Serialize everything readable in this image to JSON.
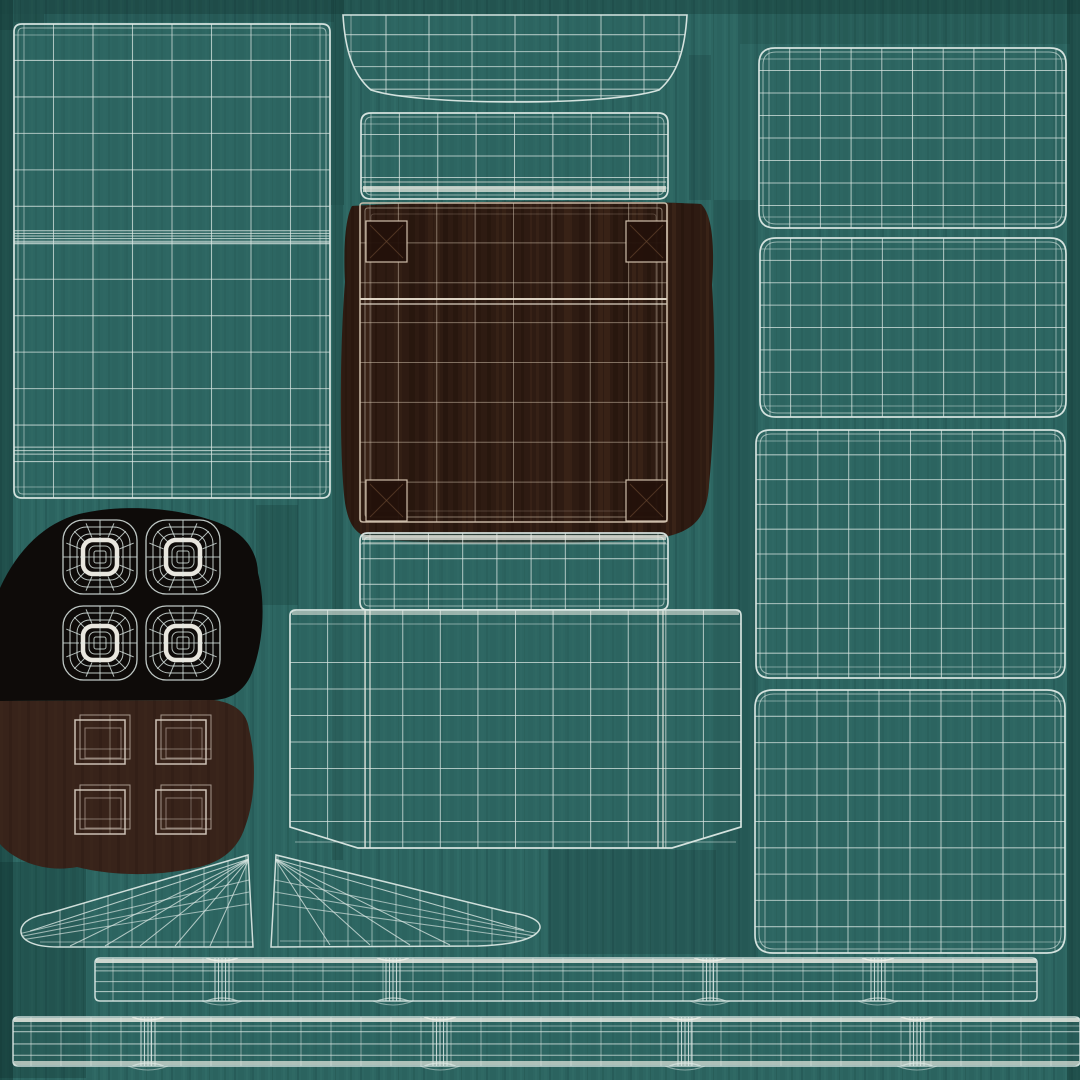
{
  "canvas": {
    "width": 1080,
    "height": 1080,
    "description": "UV wireframe texture atlas of a chair 3D model"
  },
  "palette": {
    "teal_base": "#2d6662",
    "teal_streak_light": "#3f7d77",
    "teal_streak_dark": "#16403d",
    "shadow_teal": "#0e2e2b",
    "wire": "#dde9e5",
    "wire_bright": "#f4f2ea",
    "wood_blob": "#2e1b12",
    "wood_plank_dark": "#1d0f07",
    "wood_plank_light": "#4d3320",
    "wood_wire": "#d6c6b2",
    "wood_corner": "#23110a",
    "pad_blob": "#0e0b09",
    "cap_blob": "#38231a",
    "cap_wire": "#ddd2c6"
  },
  "islands": [
    {
      "name": "backrest-panel",
      "type": "grid",
      "x": 14,
      "y": 24,
      "w": 316,
      "h": 474,
      "rx": 8,
      "cols": 8,
      "rows": 13,
      "clustersY": [
        {
          "at": 0.45,
          "n": 6,
          "gap": 2.6
        },
        {
          "at": 0.9,
          "n": 3,
          "gap": 3.5
        }
      ]
    },
    {
      "name": "headrest-cap",
      "type": "cap",
      "x": 343,
      "y": 14,
      "w": 344,
      "h": 94,
      "cols": 8,
      "rowFracs": [
        0.22,
        0.4,
        0.56,
        0.7,
        0.8,
        0.87,
        0.93
      ],
      "path": "M343,15 L687,15 C685,48 678,74 659,90 C610,106 420,106 371,90 C352,74 345,48 343,15 Z"
    },
    {
      "name": "headrest-band",
      "type": "grid",
      "x": 361,
      "y": 113,
      "w": 307,
      "h": 86,
      "rx": 10,
      "cols": 8,
      "rows": 4,
      "bright": "bottom"
    },
    {
      "name": "tabletop-wood-panel",
      "type": "wood",
      "path": "M352,206 C430,201 630,200 701,204 C712,214 715,245 712,285 C716,345 715,425 709,485 C707,517 694,533 658,538 C560,546 420,545 370,538 C350,533 345,515 343,482 C339,420 341,330 345,282 C343,246 346,216 352,206 Z",
      "frame": {
        "x": 360,
        "y": 203,
        "w": 307,
        "h": 319
      },
      "cols": 8,
      "rows": 8,
      "brightY": 299,
      "corners": [
        [
          366,
          221
        ],
        [
          626,
          221
        ],
        [
          366,
          480
        ],
        [
          626,
          480
        ]
      ],
      "cornerSize": 41
    },
    {
      "name": "seat-band",
      "type": "grid",
      "x": 360,
      "y": 533,
      "w": 308,
      "h": 77,
      "rx": 8,
      "cols": 9,
      "rows": 3,
      "bright": "top"
    },
    {
      "name": "seat-shell",
      "type": "tee",
      "path": "M296,610 L736,610 Q741,610 741,616 L741,827 L672,848 L358,848 L290,827 L290,616 Q290,610 296,610 Z",
      "x": 290,
      "y": 610,
      "w": 451,
      "h": 238,
      "cols": 12,
      "rows": 7,
      "brightCols": [
        365,
        370,
        658,
        663
      ]
    },
    {
      "name": "foot-pads",
      "type": "pads",
      "path": "M0,588 C18,549 45,523 79,514 C122,504 173,507 214,521 C243,531 257,549 258,573 C266,603 263,643 253,670 C246,690 232,699 214,700 L0,701 Z",
      "centers": [
        [
          100,
          557
        ],
        [
          183,
          557
        ],
        [
          100,
          643
        ],
        [
          183,
          643
        ]
      ]
    },
    {
      "name": "leg-caps",
      "type": "caps",
      "path": "M0,701 L214,700 C235,703 247,713 249,729 C257,763 255,801 245,827 C237,852 217,865 189,869 C151,877 109,875 77,867 C45,873 15,861 0,844 Z",
      "centers": [
        [
          101,
          741
        ],
        [
          182,
          741
        ],
        [
          101,
          811
        ],
        [
          182,
          811
        ]
      ]
    },
    {
      "name": "armrest-wedge-left",
      "type": "wedge",
      "path": "M248,855 L253,947 L58,947 C33,947 20,940 21,930 C22,921 33,916 50,913 Z",
      "apex": [
        249,
        859
      ],
      "tip": [
        30,
        931
      ],
      "bottomY": 946,
      "fanXs": [
        70,
        105,
        140,
        175,
        210
      ],
      "vxFrom": 60,
      "vxTo": 240,
      "dir": -1
    },
    {
      "name": "armrest-wedge-right",
      "type": "wedge",
      "path": "M276,855 L271,947 L478,946 C512,945 537,939 540,928 C541,920 528,915 508,912 Z",
      "apex": [
        275,
        859
      ],
      "tip": [
        524,
        930
      ],
      "bottomY": 945,
      "fanXs": [
        330,
        370,
        410,
        450
      ],
      "vxFrom": 300,
      "vxTo": 520,
      "dir": 1
    },
    {
      "name": "side-rail-top",
      "type": "strip",
      "x": 95,
      "y": 958,
      "w": 942,
      "h": 43,
      "knots": [
        222,
        393,
        710,
        878
      ]
    },
    {
      "name": "side-rail-bottom",
      "type": "strip",
      "x": 13,
      "y": 1017,
      "w": 1067,
      "h": 49,
      "knots": [
        148,
        440,
        685,
        917
      ],
      "brightBottom": true
    },
    {
      "name": "cushion-a",
      "type": "grid",
      "x": 759,
      "y": 48,
      "w": 307,
      "h": 180,
      "rx": 16,
      "cols": 10,
      "rows": 8
    },
    {
      "name": "cushion-b",
      "type": "grid",
      "x": 760,
      "y": 238,
      "w": 306,
      "h": 179,
      "rx": 16,
      "cols": 10,
      "rows": 8
    },
    {
      "name": "cushion-c",
      "type": "grid",
      "x": 756,
      "y": 430,
      "w": 309,
      "h": 248,
      "rx": 14,
      "cols": 10,
      "rows": 10
    },
    {
      "name": "cushion-d",
      "type": "grid",
      "x": 755,
      "y": 690,
      "w": 310,
      "h": 263,
      "rx": 18,
      "cols": 10,
      "rows": 10
    }
  ]
}
